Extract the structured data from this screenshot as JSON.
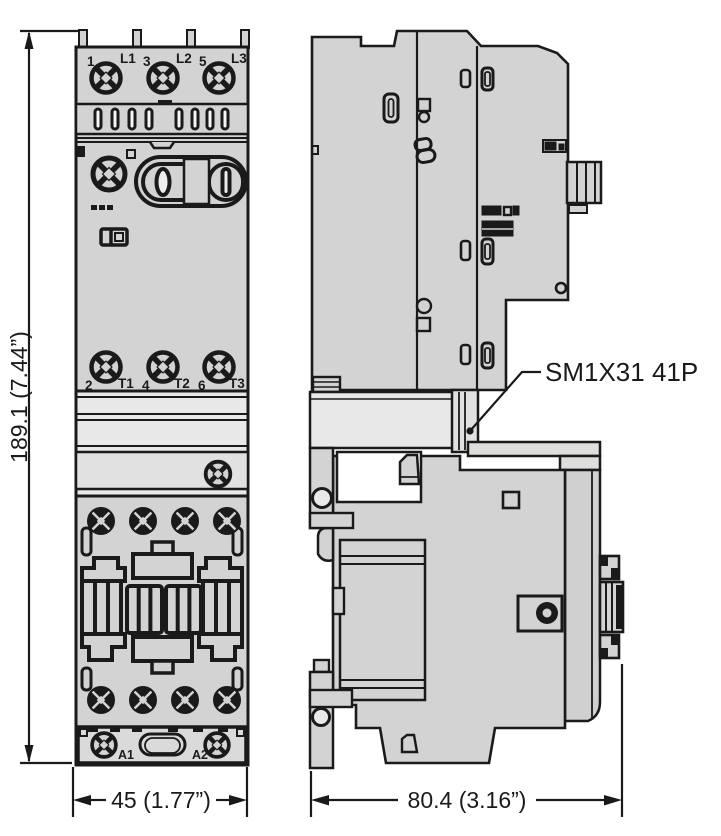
{
  "drawing_type": "dimension-drawing",
  "product_label": "SM1X31 41P",
  "dimensions": {
    "height": "189.1 (7.44”)",
    "width_front": "45 (1.77”)",
    "depth_side": "80.4 (3.16”)"
  },
  "front_view": {
    "line_terminals": [
      {
        "num": "1",
        "phase": "L1"
      },
      {
        "num": "3",
        "phase": "L2"
      },
      {
        "num": "5",
        "phase": "L3"
      }
    ],
    "load_terminals": [
      {
        "num": "2",
        "phase": "T1"
      },
      {
        "num": "4",
        "phase": "T2"
      },
      {
        "num": "6",
        "phase": "T3"
      }
    ],
    "coil_terminals": [
      {
        "label": "A1"
      },
      {
        "label": "A2"
      }
    ],
    "rocker": {
      "off_symbol": "0",
      "on_symbol": "I"
    }
  },
  "colors": {
    "body": "#d2d3d2",
    "light_band": "#e7e8e7",
    "strip": "#d9dad9",
    "line": "#1a1a1a",
    "background": "#ffffff"
  }
}
